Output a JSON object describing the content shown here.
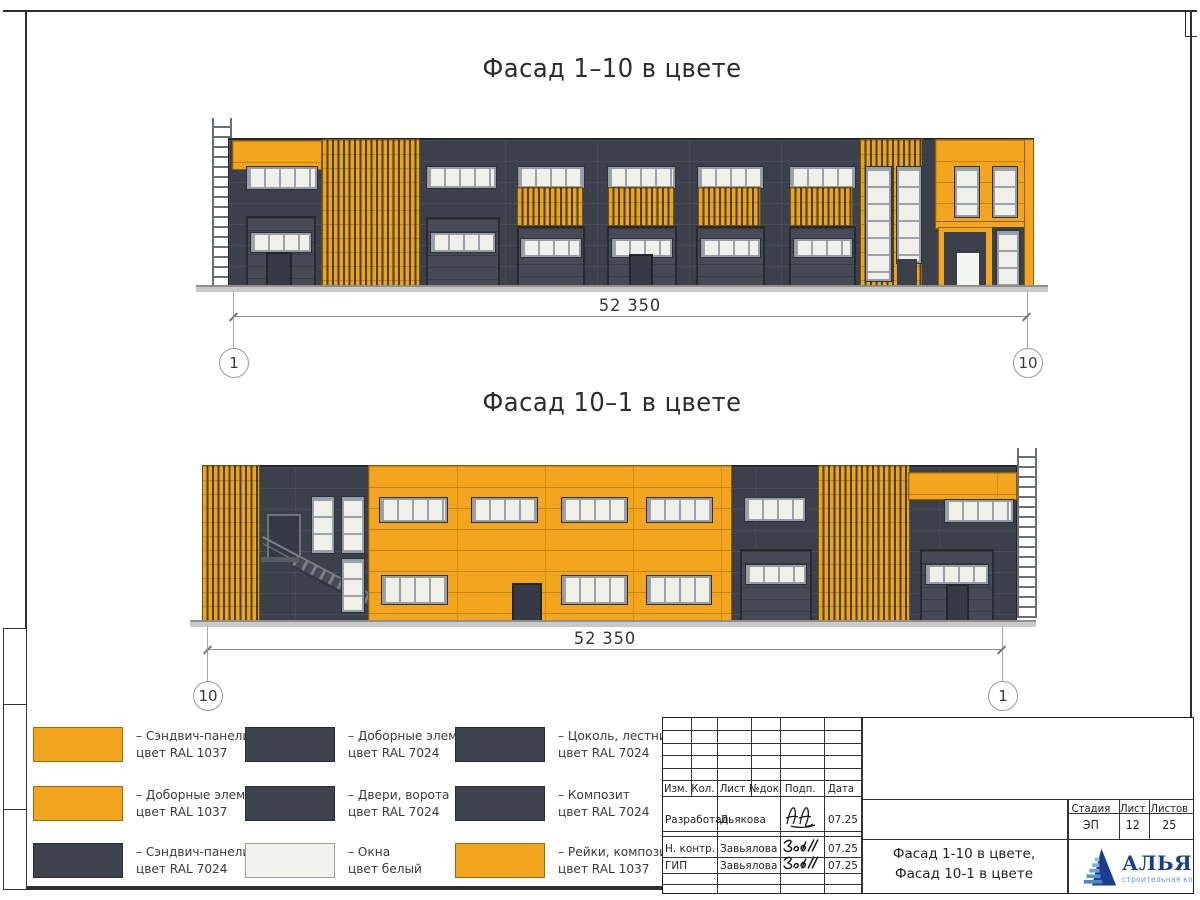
{
  "sheet": {
    "facade1": {
      "title": "Фасад 1–10 в цвете",
      "dimension": "52 350",
      "axis_left": "1",
      "axis_right": "10"
    },
    "facade2": {
      "title": "Фасад 10–1 в цвете",
      "dimension": "52 350",
      "axis_left": "10",
      "axis_right": "1"
    }
  },
  "colors": {
    "orange_ral1037": "#F2A41D",
    "gray_ral7024": "#3E434D",
    "window_white": "#F2F4EC"
  },
  "legend": {
    "items": [
      {
        "color": "#F2A41D",
        "line1": "– Сэндвич-панели",
        "line2": "цвет RAL 1037"
      },
      {
        "color": "#3E434D",
        "line1": "– Доборные элементы",
        "line2": "цвет RAL 7024"
      },
      {
        "color": "#3E434D",
        "line1": "– Цоколь, лестница",
        "line2": "цвет RAL 7024"
      },
      {
        "color": "#F2A41D",
        "line1": "– Доборные элементы",
        "line2": "цвет RAL 1037"
      },
      {
        "color": "#3E434D",
        "line1": "– Двери, ворота",
        "line2": "цвет RAL 7024"
      },
      {
        "color": "#3E434D",
        "line1": "– Композит",
        "line2": "цвет RAL 7024"
      },
      {
        "color": "#3E434D",
        "line1": "– Сэндвич-панели",
        "line2": "цвет RAL 7024"
      },
      {
        "color": "#F2F4EC",
        "line1": "– Окна",
        "line2": "цвет белый"
      },
      {
        "color": "#F2A41D",
        "line1": "– Рейки, композит",
        "line2": "цвет RAL 1037"
      }
    ]
  },
  "titleblock": {
    "columns": {
      "izm": "Изм.",
      "kol": "Кол.",
      "list": "Лист",
      "ndok": "№док.",
      "podp": "Подп.",
      "data": "Дата"
    },
    "rows": [
      {
        "role": "Разработал",
        "name": "Дьякова",
        "date": "07.25"
      },
      {
        "role": "Н. контр.",
        "name": "Завьялова",
        "date": "07.25"
      },
      {
        "role": "ГИП",
        "name": "Завьялова",
        "date": "07.25"
      }
    ],
    "doc_title_line1": "Фасад 1-10 в цвете,",
    "doc_title_line2": "Фасад 10-1 в цвете",
    "stage": {
      "label": "Стадия",
      "value": "ЭП"
    },
    "sheet_num": {
      "label": "Лист",
      "value": "12"
    },
    "sheets_total": {
      "label": "Листов",
      "value": "25"
    },
    "logo": {
      "name": "АЛЬЯНС",
      "subtitle": "строительная компания"
    }
  }
}
